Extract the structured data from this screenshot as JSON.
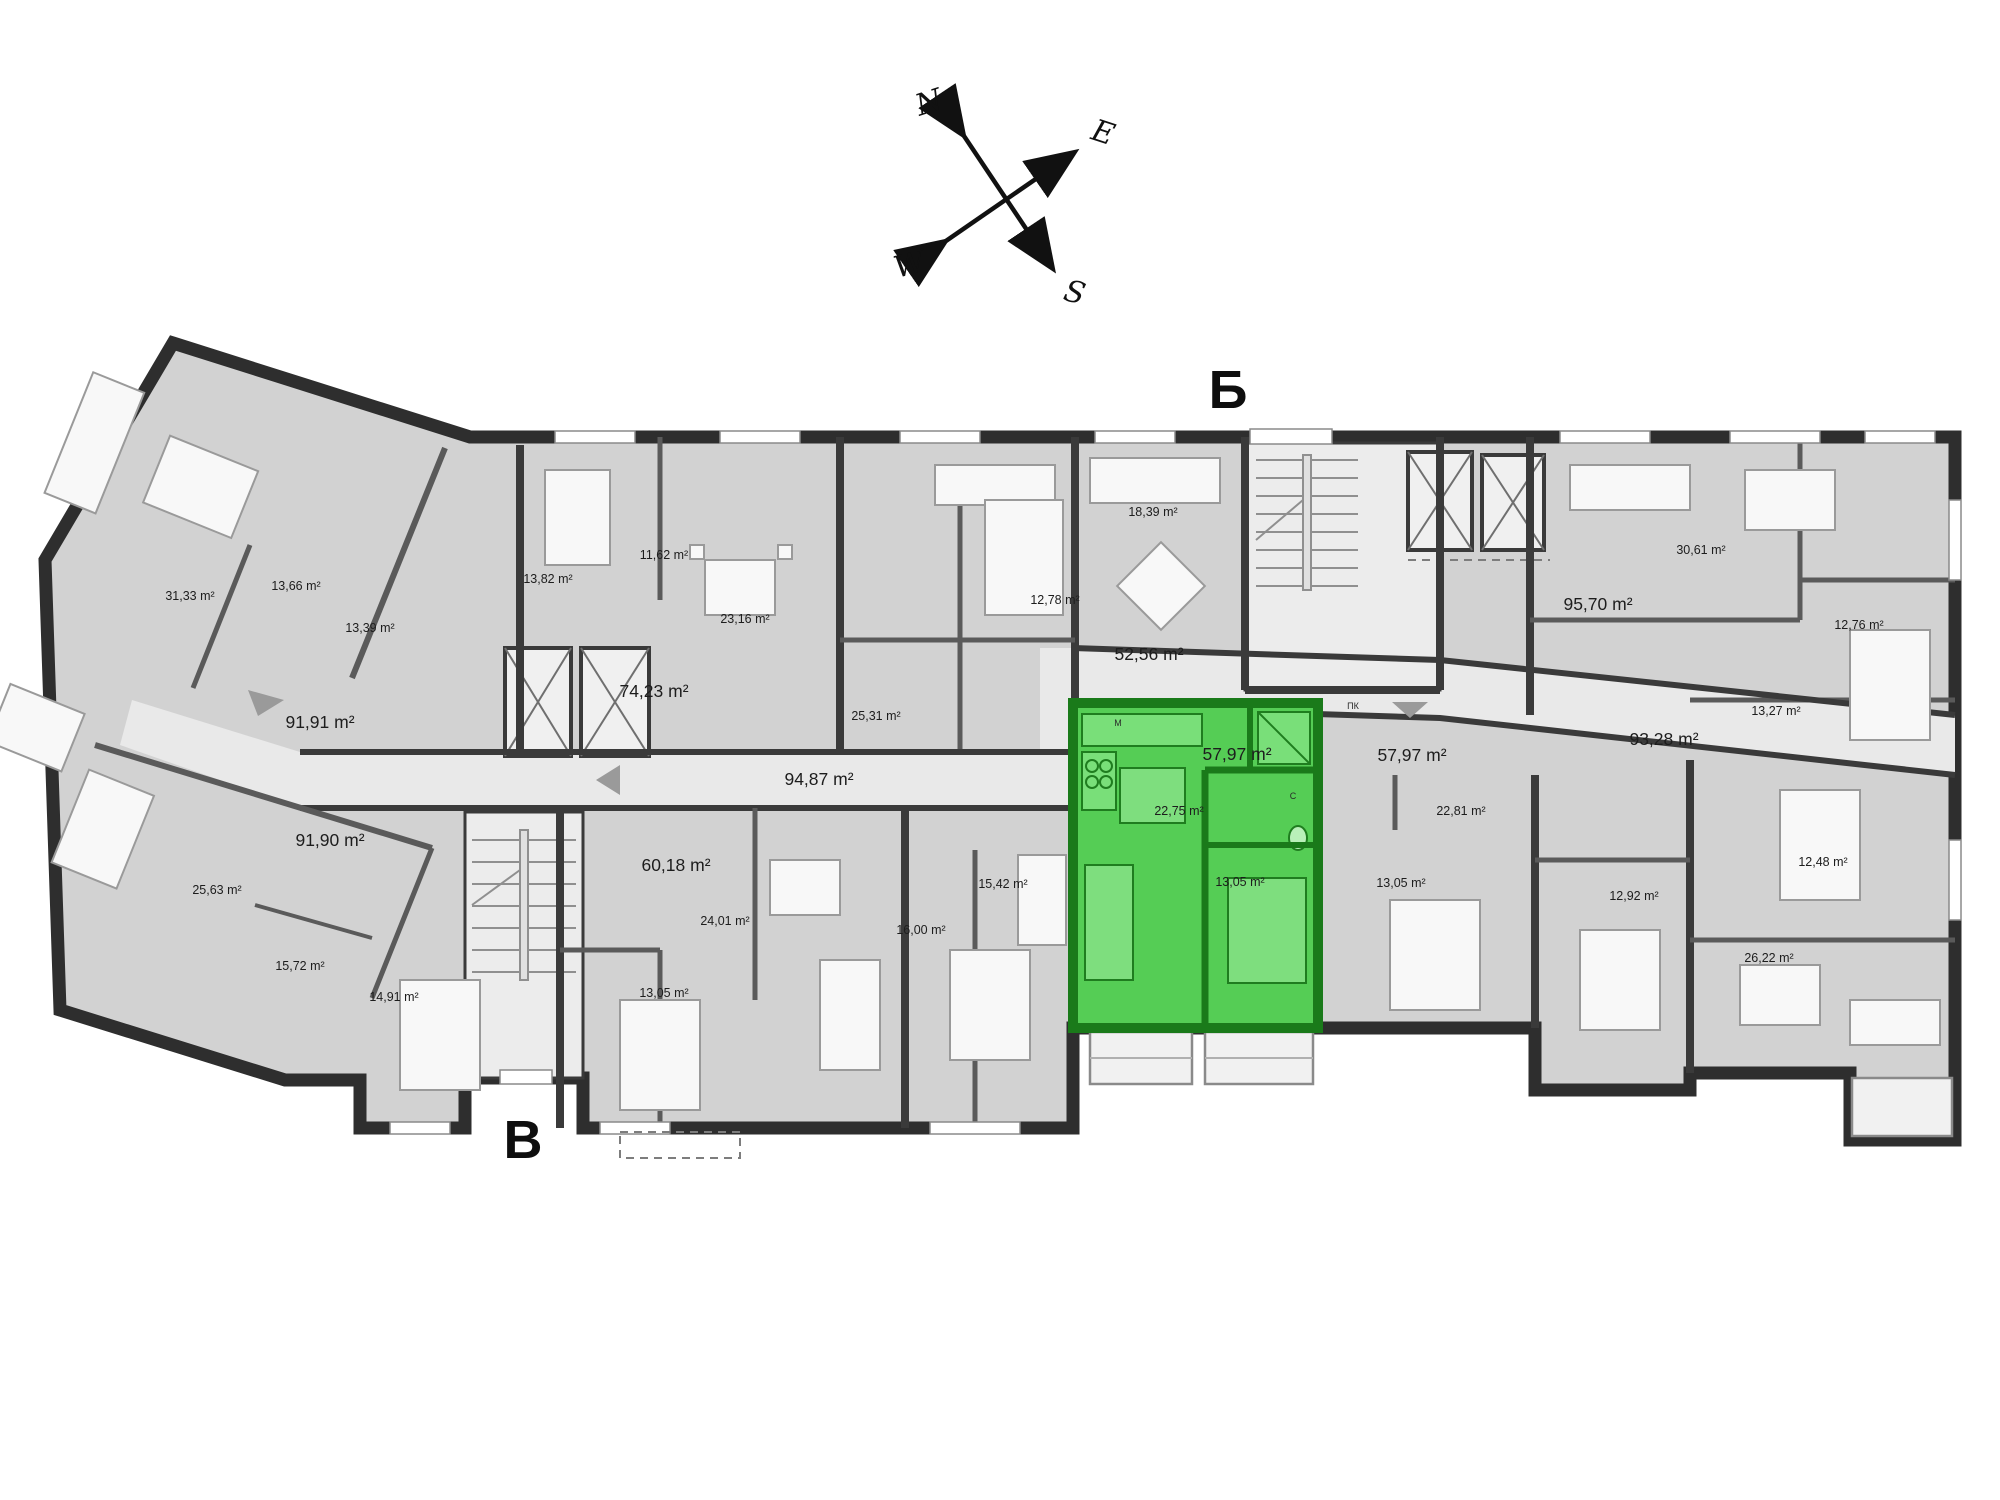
{
  "compass": {
    "north": "N",
    "east": "E",
    "south": "S",
    "west": "W",
    "north_color": "#2323cc",
    "south_color": "#cc1d1d",
    "arrow_color": "#111111"
  },
  "entrances": {
    "top_label": "Б",
    "bottom_label": "В"
  },
  "highlight_color": "#55cd55",
  "highlighted_apartment": {
    "total_area": "57,97 m²",
    "living_area": "22,75 m²",
    "bedroom_area": "13,05 m²"
  },
  "area_labels": [
    {
      "t": "31,33 m²",
      "x": 190,
      "y": 600
    },
    {
      "t": "13,66 m²",
      "x": 296,
      "y": 590
    },
    {
      "t": "13,39 m²",
      "x": 370,
      "y": 632
    },
    {
      "t": "91,91 m²",
      "x": 320,
      "y": 728,
      "big": true
    },
    {
      "t": "13,82 m²",
      "x": 548,
      "y": 583
    },
    {
      "t": "11,62 m²",
      "x": 664,
      "y": 559
    },
    {
      "t": "23,16 m²",
      "x": 745,
      "y": 623
    },
    {
      "t": "74,23 m²",
      "x": 654,
      "y": 697,
      "big": true
    },
    {
      "t": "25,31 m²",
      "x": 876,
      "y": 720
    },
    {
      "t": "12,78 m²",
      "x": 1055,
      "y": 604
    },
    {
      "t": "18,39 m²",
      "x": 1153,
      "y": 516
    },
    {
      "t": "52,56 m²",
      "x": 1149,
      "y": 660,
      "big": true
    },
    {
      "t": "94,87 m²",
      "x": 819,
      "y": 785,
      "big": true
    },
    {
      "t": "91,90 m²",
      "x": 330,
      "y": 846,
      "big": true
    },
    {
      "t": "25,63 m²",
      "x": 217,
      "y": 894
    },
    {
      "t": "15,72 m²",
      "x": 300,
      "y": 970
    },
    {
      "t": "14,91 m²",
      "x": 394,
      "y": 1001
    },
    {
      "t": "60,18 m²",
      "x": 676,
      "y": 871,
      "big": true
    },
    {
      "t": "24,01 m²",
      "x": 725,
      "y": 925
    },
    {
      "t": "13,05 m²",
      "x": 664,
      "y": 997
    },
    {
      "t": "16,00 m²",
      "x": 921,
      "y": 934
    },
    {
      "t": "15,42 m²",
      "x": 1003,
      "y": 888
    },
    {
      "t": "57,97 m²",
      "x": 1237,
      "y": 760,
      "big": true
    },
    {
      "t": "22,75 m²",
      "x": 1179,
      "y": 815
    },
    {
      "t": "13,05 m²",
      "x": 1240,
      "y": 886
    },
    {
      "t": "57,97 m²",
      "x": 1412,
      "y": 761,
      "big": true
    },
    {
      "t": "22,81 m²",
      "x": 1461,
      "y": 815
    },
    {
      "t": "13,05 m²",
      "x": 1401,
      "y": 887
    },
    {
      "t": "93,28 m²",
      "x": 1664,
      "y": 745,
      "big": true
    },
    {
      "t": "95,70 m²",
      "x": 1598,
      "y": 610,
      "big": true
    },
    {
      "t": "30,61 m²",
      "x": 1701,
      "y": 554
    },
    {
      "t": "12,76 m²",
      "x": 1859,
      "y": 629
    },
    {
      "t": "13,27 m²",
      "x": 1776,
      "y": 715
    },
    {
      "t": "12,48 m²",
      "x": 1823,
      "y": 866
    },
    {
      "t": "12,92 m²",
      "x": 1634,
      "y": 900
    },
    {
      "t": "26,22 m²",
      "x": 1769,
      "y": 962
    }
  ],
  "small_marks": [
    {
      "t": "М",
      "x": 1118,
      "y": 726
    },
    {
      "t": "ПК",
      "x": 1353,
      "y": 709
    },
    {
      "t": "С",
      "x": 1293,
      "y": 799
    }
  ]
}
